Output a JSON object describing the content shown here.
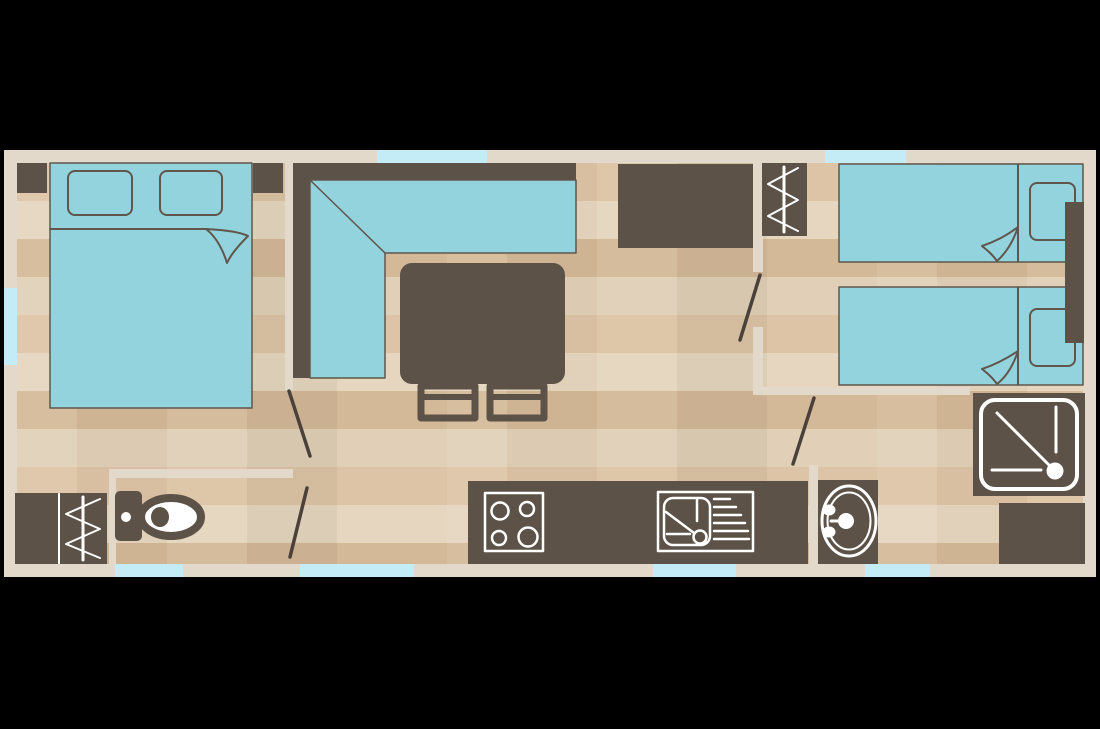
{
  "scene": {
    "kind": "mobile-home-floor-plan",
    "background": "#000000",
    "plan_bounds": {
      "x": 4,
      "y": 150,
      "w": 1092,
      "h": 427
    }
  },
  "palette": {
    "black": "#000000",
    "wall": "#e3d9cb",
    "window": "#c3ecf6",
    "dark": "#5c5247",
    "aqua": "#93d3dd",
    "outline": "#60564c",
    "door": "#4a423a",
    "sym": "#ffffff",
    "floor_light": "#e5d5be",
    "floor_dark": "#d3b897"
  },
  "inventory": {
    "rooms": [
      "master-bedroom",
      "living-dining",
      "kitchen",
      "hallway",
      "twin-bedroom",
      "toilet-room",
      "shower-room"
    ],
    "windows_top": 2,
    "windows_left": 1,
    "windows_bottom": 4,
    "interior_doors": 4,
    "furniture": [
      "double-bed",
      "nightstand-left",
      "nightstand-right",
      "corner-sofa",
      "dining-table",
      "chair",
      "chair",
      "kitchen-cabinet",
      "wardrobe-hanging",
      "twin-bed",
      "twin-bed",
      "twin-nightstand",
      "kitchen-counter",
      "hob-icon",
      "sink-icon",
      "washbasin-icon",
      "shower-icon",
      "toilet-icon",
      "storage-cabinet",
      "wardrobe-hanging"
    ]
  },
  "shapes": [
    {
      "name": "outer-wall-top",
      "type": "rect",
      "x": 4,
      "y": 150,
      "w": 1092,
      "h": 13,
      "fill": "wall"
    },
    {
      "name": "outer-wall-bottom",
      "type": "rect",
      "x": 4,
      "y": 564,
      "w": 1092,
      "h": 13,
      "fill": "wall"
    },
    {
      "name": "outer-wall-left",
      "type": "rect",
      "x": 4,
      "y": 163,
      "w": 13,
      "h": 401,
      "fill": "wall"
    },
    {
      "name": "outer-wall-right",
      "type": "rect",
      "x": 1083,
      "y": 163,
      "w": 13,
      "h": 401,
      "fill": "wall"
    },
    {
      "name": "window-top-living",
      "type": "rect",
      "x": 377,
      "y": 150,
      "w": 110,
      "h": 13,
      "fill": "window"
    },
    {
      "name": "window-top-twin",
      "type": "rect",
      "x": 825,
      "y": 150,
      "w": 81,
      "h": 13,
      "fill": "window"
    },
    {
      "name": "window-left-master",
      "type": "rect",
      "x": 4,
      "y": 288,
      "w": 13,
      "h": 77,
      "fill": "window"
    },
    {
      "name": "window-bottom-master",
      "type": "rect",
      "x": 115,
      "y": 564,
      "w": 68,
      "h": 13,
      "fill": "window"
    },
    {
      "name": "window-bottom-hall",
      "type": "rect",
      "x": 300,
      "y": 564,
      "w": 114,
      "h": 13,
      "fill": "window"
    },
    {
      "name": "window-bottom-kitchen",
      "type": "rect",
      "x": 653,
      "y": 564,
      "w": 83,
      "h": 13,
      "fill": "window"
    },
    {
      "name": "window-bottom-shower",
      "type": "rect",
      "x": 865,
      "y": 564,
      "w": 65,
      "h": 13,
      "fill": "window"
    },
    {
      "name": "wall-master-partition",
      "type": "rect",
      "x": 285,
      "y": 163,
      "w": 8,
      "h": 227,
      "fill": "wall"
    },
    {
      "name": "wall-toilet-top",
      "type": "rect",
      "x": 109,
      "y": 469,
      "w": 184,
      "h": 9,
      "fill": "wall"
    },
    {
      "name": "wall-toilet-left",
      "type": "rect",
      "x": 109,
      "y": 478,
      "w": 7,
      "h": 86,
      "fill": "wall"
    },
    {
      "name": "wall-hall-upper",
      "type": "rect",
      "x": 753,
      "y": 163,
      "w": 10,
      "h": 109,
      "fill": "wall"
    },
    {
      "name": "wall-hall-lower",
      "type": "rect",
      "x": 753,
      "y": 327,
      "w": 10,
      "h": 64,
      "fill": "wall"
    },
    {
      "name": "wall-twin-bottom",
      "type": "rect",
      "x": 753,
      "y": 387,
      "w": 217,
      "h": 8,
      "fill": "wall"
    },
    {
      "name": "wall-basin-left",
      "type": "rect",
      "x": 809,
      "y": 465,
      "w": 9,
      "h": 99,
      "fill": "wall"
    },
    {
      "name": "nightstand-left",
      "type": "rect",
      "x": 17,
      "y": 163,
      "w": 30,
      "h": 30,
      "fill": "dark"
    },
    {
      "name": "nightstand-right",
      "type": "rect",
      "x": 253,
      "y": 163,
      "w": 30,
      "h": 30,
      "fill": "dark"
    },
    {
      "name": "double-bed",
      "type": "rect",
      "x": 50,
      "y": 163,
      "w": 202,
      "h": 245,
      "fill": "aqua",
      "stroke": "outline",
      "sw": 1.5
    },
    {
      "name": "double-bed-pillow-left",
      "type": "rect",
      "x": 68,
      "y": 171,
      "w": 64,
      "h": 44,
      "rx": 7,
      "fill": "aqua",
      "stroke": "outline",
      "sw": 2
    },
    {
      "name": "double-bed-pillow-right",
      "type": "rect",
      "x": 160,
      "y": 171,
      "w": 62,
      "h": 44,
      "rx": 7,
      "fill": "aqua",
      "stroke": "outline",
      "sw": 2
    },
    {
      "name": "double-bed-sheet-line",
      "type": "line",
      "x1": 50,
      "y1": 229,
      "x2": 207,
      "y2": 229,
      "stroke": "outline",
      "sw": 2
    },
    {
      "name": "double-bed-sheet-fold",
      "type": "path",
      "d": "M206,229 C226,230 240,232 248,236 C239,245 231,254 227,263 C222,247 215,236 206,229 Z",
      "fill": "aqua",
      "stroke": "outline",
      "sw": 2
    },
    {
      "name": "sofa-back-top",
      "type": "rect",
      "x": 293,
      "y": 163,
      "w": 283,
      "h": 17,
      "fill": "dark"
    },
    {
      "name": "sofa-back-left",
      "type": "rect",
      "x": 293,
      "y": 163,
      "w": 17,
      "h": 215,
      "fill": "dark"
    },
    {
      "name": "sofa-seat",
      "type": "polygon",
      "points": "310,180 576,180 576,253 385,253 385,378 310,378",
      "fill": "aqua",
      "stroke": "outline",
      "sw": 1.5
    },
    {
      "name": "sofa-corner-seam",
      "type": "line",
      "x1": 310,
      "y1": 180,
      "x2": 385,
      "y2": 253,
      "stroke": "outline",
      "sw": 1.5
    },
    {
      "name": "dining-table",
      "type": "rect",
      "x": 400,
      "y": 263,
      "w": 165,
      "h": 121,
      "rx": 12,
      "fill": "dark"
    },
    {
      "name": "chair-left",
      "type": "rect",
      "x": 421,
      "y": 386,
      "w": 54,
      "h": 32,
      "fill": "none",
      "stroke": "dark",
      "sw": 7
    },
    {
      "name": "chair-left-bar",
      "type": "line",
      "x1": 424,
      "y1": 397,
      "x2": 472,
      "y2": 397,
      "stroke": "dark",
      "sw": 6
    },
    {
      "name": "chair-right",
      "type": "rect",
      "x": 490,
      "y": 386,
      "w": 54,
      "h": 32,
      "fill": "none",
      "stroke": "dark",
      "sw": 7
    },
    {
      "name": "chair-right-bar",
      "type": "line",
      "x1": 493,
      "y1": 397,
      "x2": 541,
      "y2": 397,
      "stroke": "dark",
      "sw": 6
    },
    {
      "name": "kitchen-cabinet",
      "type": "rect",
      "x": 618,
      "y": 164,
      "w": 135,
      "h": 84,
      "fill": "dark"
    },
    {
      "name": "wardrobe-hall",
      "type": "rect",
      "x": 762,
      "y": 163,
      "w": 45,
      "h": 73,
      "fill": "dark"
    },
    {
      "name": "wardrobe-hall-rail",
      "type": "line",
      "x1": 784,
      "y1": 167,
      "x2": 784,
      "y2": 232,
      "stroke": "sym",
      "sw": 3
    },
    {
      "name": "wardrobe-hall-hangers-icon",
      "type": "polyline",
      "points": "798,168 768,184 798,200 768,216 798,231",
      "fill": "none",
      "stroke": "sym",
      "sw": 2
    },
    {
      "name": "twin-bed-1",
      "type": "rect",
      "x": 839,
      "y": 164,
      "w": 244,
      "h": 98,
      "fill": "aqua",
      "stroke": "outline",
      "sw": 1.5
    },
    {
      "name": "twin-bed-1-fold-line",
      "type": "line",
      "x1": 1018,
      "y1": 165,
      "x2": 1018,
      "y2": 261,
      "stroke": "outline",
      "sw": 2
    },
    {
      "name": "twin-bed-1-pillow",
      "type": "rect",
      "x": 1030,
      "y": 183,
      "w": 45,
      "h": 57,
      "rx": 7,
      "fill": "aqua",
      "stroke": "outline",
      "sw": 2
    },
    {
      "name": "twin-bed-1-sheet-fold",
      "type": "path",
      "d": "M1018,227 C1013,242 1006,253 997,261 C992,254 987,250 982,246 C997,241 1009,234 1018,227 Z",
      "fill": "aqua",
      "stroke": "outline",
      "sw": 2
    },
    {
      "name": "twin-bed-2",
      "type": "rect",
      "x": 839,
      "y": 287,
      "w": 244,
      "h": 98,
      "fill": "aqua",
      "stroke": "outline",
      "sw": 1.5
    },
    {
      "name": "twin-bed-2-fold-line",
      "type": "line",
      "x1": 1018,
      "y1": 288,
      "x2": 1018,
      "y2": 384,
      "stroke": "outline",
      "sw": 2
    },
    {
      "name": "twin-bed-2-pillow",
      "type": "rect",
      "x": 1030,
      "y": 309,
      "w": 45,
      "h": 57,
      "rx": 7,
      "fill": "aqua",
      "stroke": "outline",
      "sw": 2
    },
    {
      "name": "twin-bed-2-sheet-fold",
      "type": "path",
      "d": "M1018,351 C1013,366 1006,377 997,384 C992,377 987,373 982,369 C997,364 1009,357 1018,351 Z",
      "fill": "aqua",
      "stroke": "outline",
      "sw": 2
    },
    {
      "name": "twin-nightstand",
      "type": "rect",
      "x": 1065,
      "y": 202,
      "w": 19,
      "h": 141,
      "fill": "dark"
    },
    {
      "name": "kitchen-counter",
      "type": "rect",
      "x": 468,
      "y": 481,
      "w": 340,
      "h": 83,
      "fill": "dark"
    },
    {
      "name": "hob-icon",
      "type": "rect",
      "x": 485,
      "y": 493,
      "w": 58,
      "h": 58,
      "fill": "none",
      "stroke": "sym",
      "sw": 2.5
    },
    {
      "name": "hob-burner-1",
      "type": "circle",
      "cx": 500,
      "cy": 511,
      "r": 8.5,
      "fill": "none",
      "stroke": "sym",
      "sw": 2.5
    },
    {
      "name": "hob-burner-2",
      "type": "circle",
      "cx": 527,
      "cy": 509,
      "r": 7,
      "fill": "none",
      "stroke": "sym",
      "sw": 2.5
    },
    {
      "name": "hob-burner-3",
      "type": "circle",
      "cx": 499,
      "cy": 538,
      "r": 7,
      "fill": "none",
      "stroke": "sym",
      "sw": 2.5
    },
    {
      "name": "hob-burner-4",
      "type": "circle",
      "cx": 528,
      "cy": 537,
      "r": 9.5,
      "fill": "none",
      "stroke": "sym",
      "sw": 2.5
    },
    {
      "name": "sink-icon",
      "type": "rect",
      "x": 658,
      "y": 492,
      "w": 95,
      "h": 59,
      "fill": "none",
      "stroke": "sym",
      "sw": 2.5
    },
    {
      "name": "sink-basin",
      "type": "rect",
      "x": 664,
      "y": 498,
      "w": 46,
      "h": 47,
      "rx": 9,
      "fill": "none",
      "stroke": "sym",
      "sw": 2.5
    },
    {
      "name": "sink-tap",
      "type": "line",
      "x1": 697,
      "y1": 500,
      "x2": 697,
      "y2": 521,
      "stroke": "sym",
      "sw": 2.5
    },
    {
      "name": "sink-tap-spout",
      "type": "line",
      "x1": 666,
      "y1": 512,
      "x2": 694,
      "y2": 533,
      "stroke": "sym",
      "sw": 2.5
    },
    {
      "name": "sink-edge",
      "type": "line",
      "x1": 667,
      "y1": 534,
      "x2": 690,
      "y2": 534,
      "stroke": "sym",
      "sw": 2.5
    },
    {
      "name": "sink-drain",
      "type": "circle",
      "cx": 700,
      "cy": 537,
      "r": 6.5,
      "fill": "none",
      "stroke": "sym",
      "sw": 2.5
    },
    {
      "name": "sink-drainer-1",
      "type": "line",
      "x1": 714,
      "y1": 499,
      "x2": 730,
      "y2": 499,
      "stroke": "sym",
      "sw": 2.5
    },
    {
      "name": "sink-drainer-2",
      "type": "line",
      "x1": 714,
      "y1": 507,
      "x2": 736,
      "y2": 507,
      "stroke": "sym",
      "sw": 2.5
    },
    {
      "name": "sink-drainer-3",
      "type": "line",
      "x1": 714,
      "y1": 515,
      "x2": 741,
      "y2": 515,
      "stroke": "sym",
      "sw": 2.5
    },
    {
      "name": "sink-drainer-4",
      "type": "line",
      "x1": 714,
      "y1": 523,
      "x2": 745,
      "y2": 523,
      "stroke": "sym",
      "sw": 2.5
    },
    {
      "name": "sink-drainer-5",
      "type": "line",
      "x1": 714,
      "y1": 531,
      "x2": 748,
      "y2": 531,
      "stroke": "sym",
      "sw": 2.5
    },
    {
      "name": "sink-drainer-6",
      "type": "line",
      "x1": 714,
      "y1": 539,
      "x2": 749,
      "y2": 539,
      "stroke": "sym",
      "sw": 2.5
    },
    {
      "name": "washbasin-unit",
      "type": "rect",
      "x": 818,
      "y": 480,
      "w": 60,
      "h": 84,
      "fill": "dark"
    },
    {
      "name": "washbasin-outer-ring",
      "type": "ellipse",
      "cx": 849,
      "cy": 521,
      "rx": 27,
      "ry": 35,
      "fill": "none",
      "stroke": "sym",
      "sw": 3
    },
    {
      "name": "washbasin-inner-ring",
      "type": "ellipse",
      "cx": 849,
      "cy": 521,
      "rx": 21.5,
      "ry": 28.5,
      "fill": "none",
      "stroke": "sym",
      "sw": 2
    },
    {
      "name": "washbasin-tap-stem",
      "type": "line",
      "x1": 831,
      "y1": 521,
      "x2": 846,
      "y2": 521,
      "stroke": "sym",
      "sw": 3
    },
    {
      "name": "washbasin-tap-handle-1",
      "type": "ellipse",
      "cx": 829,
      "cy": 510,
      "rx": 6.5,
      "ry": 5.5,
      "fill": "sym"
    },
    {
      "name": "washbasin-tap-handle-2",
      "type": "ellipse",
      "cx": 829,
      "cy": 532,
      "rx": 6.5,
      "ry": 5.5,
      "fill": "sym"
    },
    {
      "name": "washbasin-drain",
      "type": "circle",
      "cx": 846,
      "cy": 521,
      "r": 8,
      "fill": "sym"
    },
    {
      "name": "shower-base",
      "type": "rect",
      "x": 973,
      "y": 393,
      "w": 112,
      "h": 103,
      "fill": "dark"
    },
    {
      "name": "shower-tray-icon",
      "type": "rect",
      "x": 981,
      "y": 400,
      "w": 96,
      "h": 89,
      "rx": 14,
      "fill": "none",
      "stroke": "sym",
      "sw": 4
    },
    {
      "name": "shower-hose",
      "type": "line",
      "x1": 997,
      "y1": 413,
      "x2": 1049,
      "y2": 465,
      "stroke": "sym",
      "sw": 3
    },
    {
      "name": "shower-rail-v",
      "type": "line",
      "x1": 1056,
      "y1": 407,
      "x2": 1056,
      "y2": 452,
      "stroke": "sym",
      "sw": 3
    },
    {
      "name": "shower-rail-h",
      "type": "line",
      "x1": 992,
      "y1": 470,
      "x2": 1041,
      "y2": 470,
      "stroke": "sym",
      "sw": 3
    },
    {
      "name": "shower-drain",
      "type": "circle",
      "cx": 1055,
      "cy": 471,
      "r": 8.5,
      "fill": "sym"
    },
    {
      "name": "cabinet-shower-room",
      "type": "rect",
      "x": 999,
      "y": 503,
      "w": 86,
      "h": 61,
      "fill": "dark"
    },
    {
      "name": "cabinet-bath",
      "type": "rect",
      "x": 15,
      "y": 493,
      "w": 43,
      "h": 71,
      "fill": "dark"
    },
    {
      "name": "wardrobe-bath",
      "type": "rect",
      "x": 60,
      "y": 493,
      "w": 47,
      "h": 71,
      "fill": "dark"
    },
    {
      "name": "cabinet-divider",
      "type": "line",
      "x1": 59,
      "y1": 494,
      "x2": 59,
      "y2": 563,
      "stroke": "sym",
      "sw": 2
    },
    {
      "name": "wardrobe-bath-rail",
      "type": "line",
      "x1": 83,
      "y1": 497,
      "x2": 83,
      "y2": 560,
      "stroke": "sym",
      "sw": 3
    },
    {
      "name": "wardrobe-bath-hangers-icon",
      "type": "polyline",
      "points": "100,499 66,514 100,529 66,544 100,558",
      "fill": "none",
      "stroke": "sym",
      "sw": 2
    },
    {
      "name": "toilet-cistern",
      "type": "rect",
      "x": 115,
      "y": 491,
      "w": 27,
      "h": 50,
      "rx": 5,
      "fill": "dark"
    },
    {
      "name": "toilet-button",
      "type": "circle",
      "cx": 126,
      "cy": 517,
      "r": 5,
      "fill": "sym"
    },
    {
      "name": "toilet-bowl-icon",
      "type": "ellipse",
      "cx": 171,
      "cy": 517,
      "rx": 30,
      "ry": 19,
      "fill": "sym",
      "stroke": "dark",
      "sw": 8
    },
    {
      "name": "toilet-outlet",
      "type": "ellipse",
      "cx": 160,
      "cy": 517,
      "rx": 9,
      "ry": 10,
      "fill": "dark"
    },
    {
      "name": "door-swing-master",
      "type": "line",
      "x1": 289,
      "y1": 391,
      "x2": 310,
      "y2": 456,
      "stroke": "door",
      "sw": 3.5
    },
    {
      "name": "door-swing-toilet",
      "type": "line",
      "x1": 307,
      "y1": 488,
      "x2": 290,
      "y2": 557,
      "stroke": "door",
      "sw": 3.5
    },
    {
      "name": "door-swing-hall",
      "type": "line",
      "x1": 760,
      "y1": 275,
      "x2": 740,
      "y2": 340,
      "stroke": "door",
      "sw": 3.5
    },
    {
      "name": "door-swing-shower",
      "type": "line",
      "x1": 814,
      "y1": 398,
      "x2": 793,
      "y2": 464,
      "stroke": "door",
      "sw": 3.5
    }
  ]
}
